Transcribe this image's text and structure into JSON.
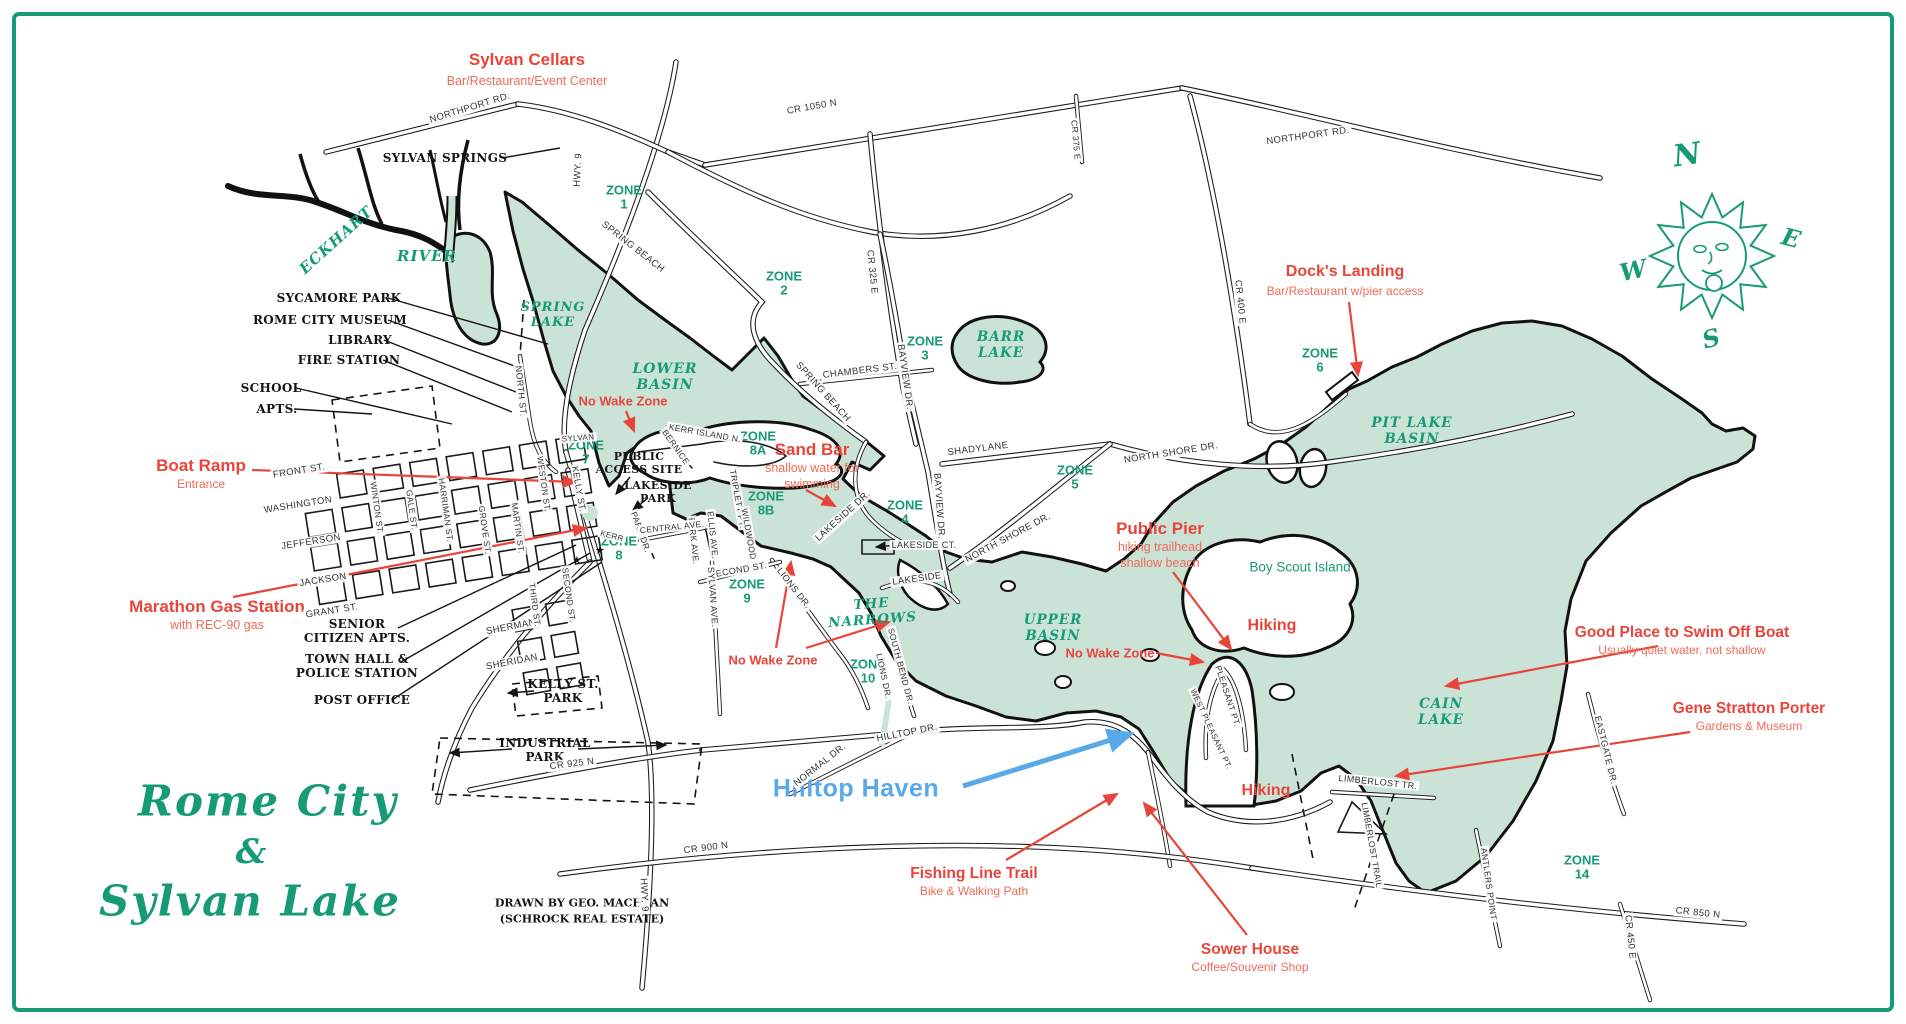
{
  "colors": {
    "green": "#169b76",
    "water": "#cbe3d7",
    "red": "#e8453a",
    "red_sub": "#ef6a57",
    "blue": "#58a9e8",
    "ink": "#141414"
  },
  "compass": {
    "n": "N",
    "e": "E",
    "s": "S",
    "w": "W"
  },
  "labels": [
    {
      "i": "sylvan-cellars-title",
      "t": "Sylvan Cellars",
      "x": 527,
      "y": 60,
      "c": "rt",
      "s": 17
    },
    {
      "i": "sylvan-cellars-sub",
      "t": "Bar/Restaurant/Event Center",
      "x": 527,
      "y": 81,
      "c": "rs",
      "s": 12.5
    },
    {
      "i": "docks-landing-title",
      "t": "Dock's Landing",
      "x": 1345,
      "y": 272,
      "c": "rt",
      "s": 16
    },
    {
      "i": "docks-landing-sub",
      "t": "Bar/Restaurant w/pier access",
      "x": 1345,
      "y": 291,
      "c": "rs"
    },
    {
      "i": "boat-ramp-title",
      "t": "Boat Ramp",
      "x": 201,
      "y": 466,
      "c": "rt",
      "s": 17
    },
    {
      "i": "boat-ramp-sub",
      "t": "Entrance",
      "x": 201,
      "y": 484,
      "c": "rs"
    },
    {
      "i": "marathon-title",
      "t": "Marathon Gas Station",
      "x": 217,
      "y": 607,
      "c": "rt",
      "s": 17
    },
    {
      "i": "marathon-sub",
      "t": "with REC-90 gas",
      "x": 217,
      "y": 625,
      "c": "rs",
      "s": 12.5
    },
    {
      "i": "sandbar-title",
      "t": "Sand Bar",
      "x": 812,
      "y": 450,
      "c": "rt",
      "s": 17
    },
    {
      "i": "sandbar-sub1",
      "t": "shallow water for",
      "x": 812,
      "y": 468,
      "c": "rs",
      "s": 12.5
    },
    {
      "i": "sandbar-sub2",
      "t": "swimming",
      "x": 812,
      "y": 484,
      "c": "rs",
      "s": 12.5
    },
    {
      "i": "public-pier-title",
      "t": "Public Pier",
      "x": 1160,
      "y": 529,
      "c": "rt",
      "s": 17
    },
    {
      "i": "public-pier-sub1",
      "t": "hiking trailhead",
      "x": 1160,
      "y": 547,
      "c": "rs",
      "s": 12.5
    },
    {
      "i": "public-pier-sub2",
      "t": "shallow beach",
      "x": 1160,
      "y": 563,
      "c": "rs",
      "s": 12.5
    },
    {
      "i": "hiking-1",
      "t": "Hiking",
      "x": 1272,
      "y": 626,
      "c": "rt",
      "s": 16
    },
    {
      "i": "hiking-2",
      "t": "Hiking",
      "x": 1266,
      "y": 791,
      "c": "rt",
      "s": 16
    },
    {
      "i": "good-swim-title",
      "t": "Good Place to Swim Off Boat",
      "x": 1682,
      "y": 633,
      "c": "rt",
      "s": 15.5
    },
    {
      "i": "good-swim-sub",
      "t": "Usually quiet water, not shallow",
      "x": 1682,
      "y": 650,
      "c": "rs"
    },
    {
      "i": "gene-title",
      "t": "Gene Stratton Porter",
      "x": 1749,
      "y": 709,
      "c": "rt",
      "s": 15.5
    },
    {
      "i": "gene-sub",
      "t": "Gardens & Museum",
      "x": 1749,
      "y": 726,
      "c": "rs"
    },
    {
      "i": "fishing-title",
      "t": "Fishing Line Trail",
      "x": 974,
      "y": 874,
      "c": "rt",
      "s": 15.5
    },
    {
      "i": "fishing-sub",
      "t": "Bike & Walking Path",
      "x": 974,
      "y": 891,
      "c": "rs"
    },
    {
      "i": "sower-title",
      "t": "Sower House",
      "x": 1250,
      "y": 950,
      "c": "rt",
      "s": 15.5
    },
    {
      "i": "sower-sub",
      "t": "Coffee/Souvenir Shop",
      "x": 1250,
      "y": 967,
      "c": "rs"
    },
    {
      "i": "no-wake-1",
      "t": "No Wake Zone",
      "x": 623,
      "y": 401,
      "c": "rw"
    },
    {
      "i": "no-wake-2",
      "t": "No Wake Zone",
      "x": 773,
      "y": 660,
      "c": "rw"
    },
    {
      "i": "no-wake-3",
      "t": "No Wake Zone",
      "x": 1110,
      "y": 653,
      "c": "rw"
    },
    {
      "i": "hilltop-haven",
      "t": "Hilltop Haven",
      "x": 856,
      "y": 789,
      "c": "bt"
    },
    {
      "i": "title-line1",
      "t": "Rome City",
      "x": 268,
      "y": 801,
      "c": "gt",
      "s": 42
    },
    {
      "i": "title-amp",
      "t": "&",
      "x": 252,
      "y": 852,
      "c": "gt",
      "s": 34
    },
    {
      "i": "title-line2",
      "t": "Sylvan Lake",
      "x": 250,
      "y": 901,
      "c": "gt",
      "s": 42
    },
    {
      "i": "credit-1",
      "t": "DRAWN BY GEO. MACHLAN",
      "x": 582,
      "y": 903,
      "c": "cr"
    },
    {
      "i": "credit-2",
      "t": "(SCHROCK REAL ESTATE)",
      "x": 582,
      "y": 919,
      "c": "cr"
    },
    {
      "i": "eckhart",
      "t": "ECKHART",
      "x": 336,
      "y": 240,
      "c": "gs",
      "r": -42,
      "s": 15
    },
    {
      "i": "river",
      "t": "RIVER",
      "x": 427,
      "y": 256,
      "c": "gs",
      "s": 15
    },
    {
      "i": "spring-lake",
      "t": "SPRING\nLAKE",
      "x": 553,
      "y": 315,
      "c": "gs",
      "s": 13
    },
    {
      "i": "lower-basin",
      "t": "LOWER\nBASIN",
      "x": 665,
      "y": 377,
      "c": "gs"
    },
    {
      "i": "barr-lake",
      "t": "BARR\nLAKE",
      "x": 1001,
      "y": 345,
      "c": "gs",
      "s": 13.5
    },
    {
      "i": "pit-lake-basin",
      "t": "PIT LAKE\nBASIN",
      "x": 1412,
      "y": 431,
      "c": "gs",
      "s": 13.5
    },
    {
      "i": "upper-basin",
      "t": "UPPER\nBASIN",
      "x": 1053,
      "y": 628,
      "c": "gs",
      "s": 13.5
    },
    {
      "i": "the-narrows",
      "t": "THE\nNARROWS",
      "x": 872,
      "y": 612,
      "c": "gs",
      "r": -4,
      "s": 13.5
    },
    {
      "i": "cain-lake",
      "t": "CAIN\nLAKE",
      "x": 1441,
      "y": 712,
      "c": "gs",
      "s": 13.5
    },
    {
      "i": "boy-scout-island",
      "t": "Boy Scout Island",
      "x": 1300,
      "y": 567,
      "c": "gsans"
    },
    {
      "i": "zone-1",
      "t": "ZONE\n1",
      "x": 624,
      "y": 197,
      "c": "gz"
    },
    {
      "i": "zone-2",
      "t": "ZONE\n2",
      "x": 784,
      "y": 283,
      "c": "gz"
    },
    {
      "i": "zone-3",
      "t": "ZONE\n3",
      "x": 925,
      "y": 348,
      "c": "gz"
    },
    {
      "i": "zone-4",
      "t": "ZONE\n4",
      "x": 905,
      "y": 512,
      "c": "gz"
    },
    {
      "i": "zone-5",
      "t": "ZONE\n5",
      "x": 1075,
      "y": 477,
      "c": "gz"
    },
    {
      "i": "zone-6",
      "t": "ZONE\n6",
      "x": 1320,
      "y": 360,
      "c": "gz"
    },
    {
      "i": "zone-7",
      "t": "ZONE\n7",
      "x": 586,
      "y": 452,
      "c": "gz"
    },
    {
      "i": "zone-8",
      "t": "ZONE\n8",
      "x": 619,
      "y": 548,
      "c": "gz"
    },
    {
      "i": "zone-8a",
      "t": "ZONE\n8A",
      "x": 758,
      "y": 443,
      "c": "gz"
    },
    {
      "i": "zone-8b",
      "t": "ZONE\n8B",
      "x": 766,
      "y": 503,
      "c": "gz"
    },
    {
      "i": "zone-9",
      "t": "ZONE\n9",
      "x": 747,
      "y": 591,
      "c": "gz"
    },
    {
      "i": "zone-10",
      "t": "ZONE\n10",
      "x": 868,
      "y": 671,
      "c": "gz"
    },
    {
      "i": "zone-14",
      "t": "ZONE\n14",
      "x": 1582,
      "y": 867,
      "c": "gz"
    },
    {
      "i": "sycamore-park",
      "t": "SYCAMORE PARK",
      "x": 339,
      "y": 298,
      "c": "bk"
    },
    {
      "i": "rome-city-museum",
      "t": "ROME CITY MUSEUM",
      "x": 330,
      "y": 320,
      "c": "bk"
    },
    {
      "i": "library",
      "t": "LIBRARY",
      "x": 360,
      "y": 340,
      "c": "bk"
    },
    {
      "i": "fire-station",
      "t": "FIRE STATION",
      "x": 349,
      "y": 360,
      "c": "bk"
    },
    {
      "i": "school",
      "t": "SCHOOL",
      "x": 271,
      "y": 388,
      "c": "bk"
    },
    {
      "i": "apts",
      "t": "APTS.",
      "x": 277,
      "y": 409,
      "c": "bk"
    },
    {
      "i": "senior-citizen-apts",
      "t": "SENIOR\nCITIZEN APTS.",
      "x": 357,
      "y": 631,
      "c": "bk"
    },
    {
      "i": "town-hall",
      "t": "TOWN HALL &\nPOLICE STATION",
      "x": 357,
      "y": 666,
      "c": "bk"
    },
    {
      "i": "post-office",
      "t": "POST OFFICE",
      "x": 362,
      "y": 700,
      "c": "bk"
    },
    {
      "i": "kelly-st-park",
      "t": "KELLY ST.\nPARK",
      "x": 563,
      "y": 691,
      "c": "bk"
    },
    {
      "i": "industrial-park",
      "t": "INDUSTRIAL\nPARK",
      "x": 545,
      "y": 750,
      "c": "bk"
    },
    {
      "i": "public-access-site",
      "t": "PUBLIC\nACCESS SITE",
      "x": 639,
      "y": 463,
      "c": "bk",
      "s": 11
    },
    {
      "i": "lakeside-park",
      "t": "LAKESIDE\nPARK",
      "x": 658,
      "y": 492,
      "c": "bk",
      "s": 11
    },
    {
      "i": "sylvan-springs",
      "t": "SYLVAN SPRINGS",
      "x": 445,
      "y": 158,
      "c": "bk"
    },
    {
      "i": "star-1",
      "t": "★",
      "x": 600,
      "y": 551,
      "c": "bk",
      "s": 10
    },
    {
      "i": "star-2",
      "t": "★",
      "x": 577,
      "y": 561,
      "c": "bk",
      "s": 9
    },
    {
      "i": "northport-rd-w",
      "t": "NORTHPORT RD.",
      "x": 470,
      "y": 108,
      "c": "rd",
      "r": -17
    },
    {
      "i": "cr-1050-n",
      "t": "CR 1050 N",
      "x": 812,
      "y": 107,
      "c": "rd",
      "r": -10
    },
    {
      "i": "northport-rd-e",
      "t": "NORTHPORT RD.",
      "x": 1308,
      "y": 136,
      "c": "rd",
      "r": -8
    },
    {
      "i": "hwy-9-top",
      "t": "HWY. 9",
      "x": 578,
      "y": 170,
      "c": "rd",
      "r": -87
    },
    {
      "i": "cr-375-e",
      "t": "CR 375 E",
      "x": 1076,
      "y": 140,
      "c": "rd",
      "r": 85,
      "s": 8.5
    },
    {
      "i": "cr-325-e",
      "t": "CR 325 E",
      "x": 872,
      "y": 272,
      "c": "rd",
      "r": 84
    },
    {
      "i": "spring-beach-1",
      "t": "SPRING BEACH",
      "x": 633,
      "y": 247,
      "c": "rd",
      "r": 38
    },
    {
      "i": "spring-beach-2",
      "t": "SPRING BEACH",
      "x": 823,
      "y": 392,
      "c": "rd",
      "r": 48
    },
    {
      "i": "chambers-st",
      "t": "CHAMBERS ST.",
      "x": 860,
      "y": 371,
      "c": "rd",
      "r": -7
    },
    {
      "i": "bayview-dr-1",
      "t": "BAYVIEW DR.",
      "x": 905,
      "y": 377,
      "c": "rd",
      "r": 82
    },
    {
      "i": "bayview-dr-2",
      "t": "BAYVIEW DR.",
      "x": 939,
      "y": 506,
      "c": "rd",
      "r": 86
    },
    {
      "i": "shadylane",
      "t": "SHADYLANE",
      "x": 978,
      "y": 449,
      "c": "rd",
      "r": -7
    },
    {
      "i": "north-shore-dr-1",
      "t": "NORTH SHORE DR.",
      "x": 1171,
      "y": 453,
      "c": "rd",
      "r": -9
    },
    {
      "i": "north-shore-dr-2",
      "t": "NORTH  SHORE  DR.",
      "x": 1008,
      "y": 538,
      "c": "rd",
      "r": -28
    },
    {
      "i": "cr-400-e",
      "t": "CR 400 E",
      "x": 1240,
      "y": 302,
      "c": "rd",
      "r": 84
    },
    {
      "i": "lakeside-dr",
      "t": "LAKESIDE DR.",
      "x": 843,
      "y": 516,
      "c": "rd",
      "r": -42
    },
    {
      "i": "lakeside-ct",
      "t": "LAKESIDE CT.",
      "x": 924,
      "y": 545,
      "c": "rd",
      "s": 9
    },
    {
      "i": "lakeside",
      "t": "LAKESIDE",
      "x": 917,
      "y": 579,
      "c": "rd",
      "r": -8
    },
    {
      "i": "kerr-island-n",
      "t": "KERR ISLAND N.",
      "x": 705,
      "y": 433,
      "c": "rd",
      "r": 10,
      "s": 8.5
    },
    {
      "i": "bernice",
      "t": "BERNICE",
      "x": 676,
      "y": 447,
      "c": "rd",
      "r": 55,
      "s": 8.5
    },
    {
      "i": "triplett-pt",
      "t": "TRIPLETT PT.",
      "x": 738,
      "y": 499,
      "c": "rd",
      "r": 80,
      "s": 8.5
    },
    {
      "i": "wildwood",
      "t": "WILDWOOD",
      "x": 749,
      "y": 534,
      "c": "rd",
      "r": 80,
      "s": 8.5
    },
    {
      "i": "ellis-ave",
      "t": "ELLIS AVE.",
      "x": 713,
      "y": 535,
      "c": "rd",
      "r": 84,
      "s": 8.5
    },
    {
      "i": "park-ave",
      "t": "PARK AVE.",
      "x": 694,
      "y": 541,
      "c": "rd",
      "r": 84,
      "s": 8.5
    },
    {
      "i": "park-dr",
      "t": "PARK DR.",
      "x": 641,
      "y": 532,
      "c": "rd",
      "r": 70,
      "s": 8.5
    },
    {
      "i": "central-ave",
      "t": "CENTRAL AVE.",
      "x": 672,
      "y": 527,
      "c": "rd",
      "r": -6,
      "s": 8.5
    },
    {
      "i": "second-st-1",
      "t": "SECOND ST.",
      "x": 738,
      "y": 570,
      "c": "rd",
      "r": -10,
      "s": 9
    },
    {
      "i": "sylvan-ave",
      "t": "SYLVAN AVE.",
      "x": 713,
      "y": 597,
      "c": "rd",
      "r": 86,
      "s": 9
    },
    {
      "i": "lions-dr-1",
      "t": "LIONS DR.",
      "x": 794,
      "y": 588,
      "c": "rd",
      "r": 52,
      "s": 9
    },
    {
      "i": "lions-dr-2",
      "t": "LIONS DR.",
      "x": 884,
      "y": 676,
      "c": "rd",
      "r": 78,
      "s": 8.5
    },
    {
      "i": "south-bend-dr",
      "t": "SOUTH BEND DR.",
      "x": 901,
      "y": 666,
      "c": "rd",
      "r": 75,
      "s": 8.5
    },
    {
      "i": "north-st",
      "t": "NORTH ST.",
      "x": 521,
      "y": 391,
      "c": "rd",
      "r": 84,
      "s": 9
    },
    {
      "i": "sylvan-short",
      "t": "SYLVAN",
      "x": 578,
      "y": 438,
      "c": "rd",
      "r": -4,
      "s": 8
    },
    {
      "i": "kelly-st",
      "t": "KELLY ST.",
      "x": 579,
      "y": 489,
      "c": "rd",
      "r": 80,
      "s": 9
    },
    {
      "i": "weston-st",
      "t": "WESTON ST.",
      "x": 544,
      "y": 484,
      "c": "rd",
      "r": 82,
      "s": 8.5
    },
    {
      "i": "front-st",
      "t": "FRONT ST.",
      "x": 299,
      "y": 471,
      "c": "rd",
      "r": -9
    },
    {
      "i": "washington",
      "t": "WASHINGTON",
      "x": 298,
      "y": 505,
      "c": "rd",
      "r": -9
    },
    {
      "i": "jefferson",
      "t": "JEFFERSON",
      "x": 311,
      "y": 542,
      "c": "rd",
      "r": -9
    },
    {
      "i": "jackson",
      "t": "JACKSON",
      "x": 323,
      "y": 580,
      "c": "rd",
      "r": -9
    },
    {
      "i": "grant-st",
      "t": "GRANT ST.",
      "x": 332,
      "y": 611,
      "c": "rd",
      "r": -9
    },
    {
      "i": "sherman",
      "t": "SHERMAN",
      "x": 511,
      "y": 627,
      "c": "rd",
      "r": -11
    },
    {
      "i": "sheridan",
      "t": "SHERIDAN",
      "x": 512,
      "y": 662,
      "c": "rd",
      "r": -11
    },
    {
      "i": "winton-st",
      "t": "WINTON ST.",
      "x": 377,
      "y": 508,
      "c": "rd",
      "r": 82,
      "s": 8.5
    },
    {
      "i": "gale-st",
      "t": "GALE ST.",
      "x": 412,
      "y": 510,
      "c": "rd",
      "r": 82,
      "s": 8.5
    },
    {
      "i": "harriman-st",
      "t": "HARRIMAN ST.",
      "x": 446,
      "y": 510,
      "c": "rd",
      "r": 82,
      "s": 8.5
    },
    {
      "i": "grove-st",
      "t": "GROVE ST.",
      "x": 485,
      "y": 530,
      "c": "rd",
      "r": 82,
      "s": 8.5
    },
    {
      "i": "martin-st",
      "t": "MARTIN ST.",
      "x": 518,
      "y": 528,
      "c": "rd",
      "r": 82,
      "s": 8.5
    },
    {
      "i": "third-st",
      "t": "THIRD ST.",
      "x": 535,
      "y": 605,
      "c": "rd",
      "r": 82,
      "s": 8.5
    },
    {
      "i": "second-st-2",
      "t": "SECOND ST.",
      "x": 569,
      "y": 595,
      "c": "rd",
      "r": 82,
      "s": 8.5
    },
    {
      "i": "kerr",
      "t": "KERR",
      "x": 612,
      "y": 536,
      "c": "rd",
      "r": 15,
      "s": 8
    },
    {
      "i": "cr-925-n",
      "t": "CR 925 N",
      "x": 572,
      "y": 764,
      "c": "rd",
      "r": -7
    },
    {
      "i": "cr-900-n",
      "t": "CR 900 N",
      "x": 706,
      "y": 848,
      "c": "rd",
      "r": -7
    },
    {
      "i": "hwy-9-bottom",
      "t": "HWY. 9",
      "x": 644,
      "y": 895,
      "c": "rd",
      "r": 87
    },
    {
      "i": "hilltop-dr",
      "t": "HILLTOP DR.",
      "x": 907,
      "y": 733,
      "c": "rd",
      "r": -11
    },
    {
      "i": "normal-dr",
      "t": "NORMAL DR.",
      "x": 820,
      "y": 765,
      "c": "rd",
      "r": -38
    },
    {
      "i": "pleasant-pt",
      "t": "PLEASANT PT.",
      "x": 1228,
      "y": 696,
      "c": "rd",
      "r": 72,
      "s": 8.5
    },
    {
      "i": "west-pleasant-pt",
      "t": "WEST PLEASANT PT.",
      "x": 1211,
      "y": 729,
      "c": "rd",
      "r": 65,
      "s": 8
    },
    {
      "i": "limberlost-tr",
      "t": "LIMBERLOST TR.",
      "x": 1378,
      "y": 782,
      "c": "rd",
      "r": 6,
      "s": 9
    },
    {
      "i": "limberlost-trail",
      "t": "LIMBERLOST TRAIL",
      "x": 1372,
      "y": 845,
      "c": "rd",
      "r": 80,
      "s": 8.5
    },
    {
      "i": "antlers-point",
      "t": "ANTLERS POINT",
      "x": 1489,
      "y": 884,
      "c": "rd",
      "r": 82,
      "s": 8.5
    },
    {
      "i": "eastgate-dr",
      "t": "EASTGATE DR.",
      "x": 1606,
      "y": 750,
      "c": "rd",
      "r": 76,
      "s": 9
    },
    {
      "i": "cr-850-n",
      "t": "CR 850 N",
      "x": 1698,
      "y": 913,
      "c": "rd",
      "r": 6
    },
    {
      "i": "cr-450-e",
      "t": "CR 450 E",
      "x": 1630,
      "y": 937,
      "c": "rd",
      "r": 84
    },
    {
      "i": "compass-n",
      "t": "N",
      "x": 1688,
      "y": 155,
      "c": "gt",
      "r": -8,
      "s": 30
    },
    {
      "i": "compass-e",
      "t": "E",
      "x": 1792,
      "y": 238,
      "c": "gt",
      "r": 15,
      "s": 24
    },
    {
      "i": "compass-w",
      "t": "W",
      "x": 1634,
      "y": 270,
      "c": "gt",
      "r": -12,
      "s": 24
    },
    {
      "i": "compass-s",
      "t": "S",
      "x": 1712,
      "y": 338,
      "c": "gt",
      "r": -15,
      "s": 24
    }
  ]
}
